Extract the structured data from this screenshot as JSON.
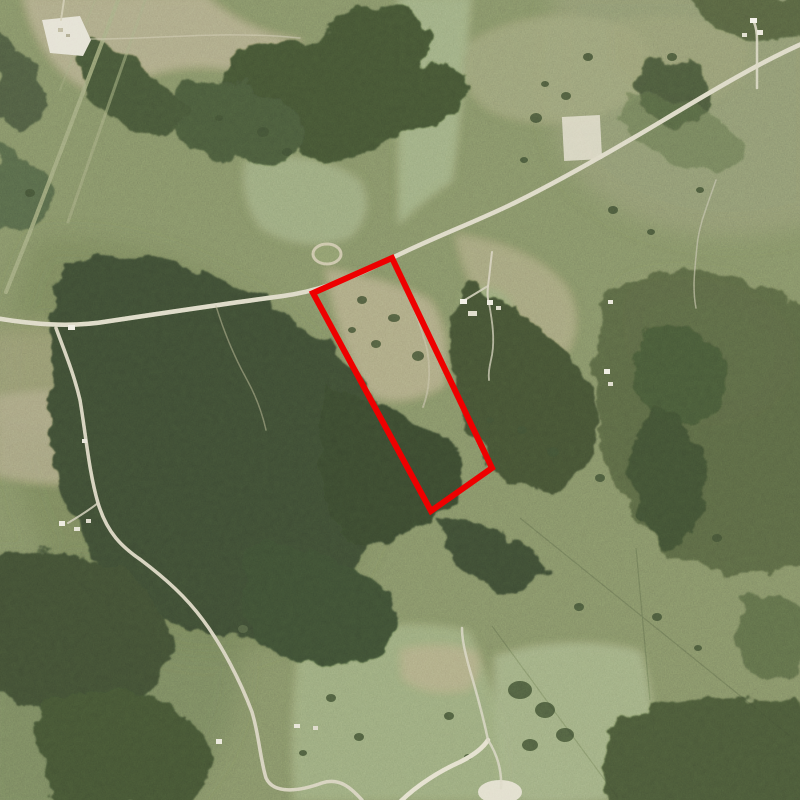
{
  "scene": {
    "type": "aerial-photograph",
    "description": "Color aerial photograph of rural ranch land: olive-green pastures, dense dark woodland, a light gravel highway crossing diagonally from upper right to left, winding country lanes, scattered farm buildings, a quarry pad in the upper left and stock ponds",
    "overlay_note": "Red outline highlights a long, narrow rectangular parcel that fronts the main road on its north end and runs southeast into dense woods"
  },
  "overlay": {
    "parcel_outline_points": "392,258 492,468 431,511 313,293",
    "boundary_color": "#ee0000"
  },
  "palette": {
    "pasture_olive": "#77805f",
    "pasture_pale_green": "#93a078",
    "field_tan": "#a59c7d",
    "forest_dark": "#35412e",
    "scrub_mid": "#4c5639",
    "road_light": "#d8d3c1",
    "bare_white": "#e0dcd0",
    "boundary_red": "#ee0000"
  }
}
